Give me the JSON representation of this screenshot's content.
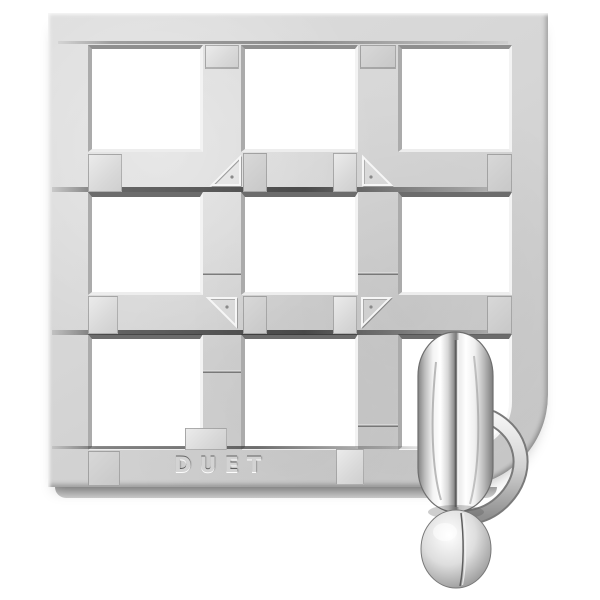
{
  "scene": {
    "type": "product-photo",
    "subject": "chrome cast-metal brain-teaser puzzle",
    "background_color": "#ffffff",
    "finish": "polished die-cast silver"
  },
  "puzzle": {
    "brand_text": "DUET",
    "grid_rows": 3,
    "grid_cols": 3,
    "pieces": [
      "front lattice",
      "back lattice (offset seams)",
      "two-part ring with knob"
    ],
    "ring_location": "hanging through bottom-right cell, knob below frame",
    "frame_corner": "rounded bottom-right corner",
    "markers": [
      {
        "name": "triangle-marker",
        "position": "upper-left intersection",
        "points": "toward-center (lower-right)"
      },
      {
        "name": "triangle-marker",
        "position": "upper-right intersection",
        "points": "toward-center (lower-left)"
      },
      {
        "name": "triangle-marker",
        "position": "lower-left intersection",
        "points": "toward-center (upper-right)"
      },
      {
        "name": "triangle-marker",
        "position": "lower-right intersection",
        "points": "toward-center (upper-left)"
      }
    ]
  },
  "colors": {
    "metal_base": "#d6d6d6",
    "metal_shadow": "#8c8c8c",
    "metal_highlight": "#ffffff",
    "seam_dark": "#4c4c4c",
    "chrome_ring_dark": "#7a7a7a"
  }
}
